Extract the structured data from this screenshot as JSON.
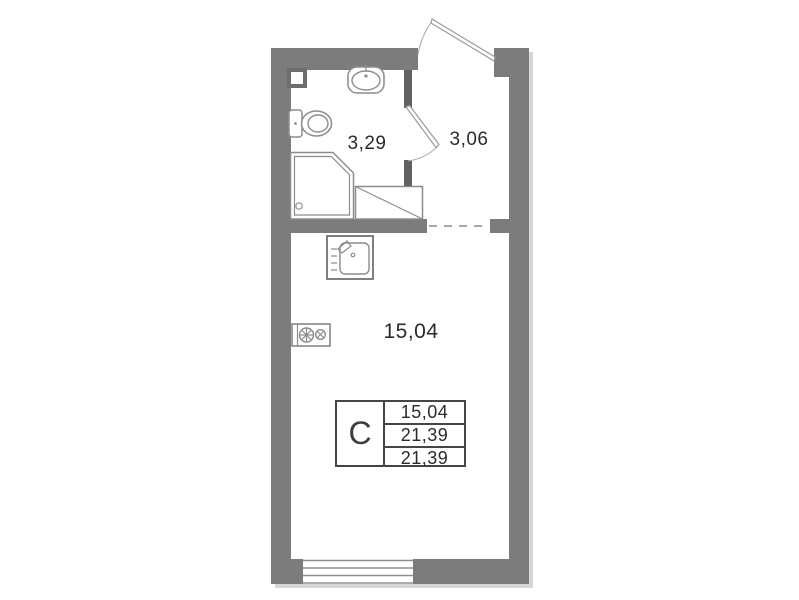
{
  "plan": {
    "kind": "studio apartment floor plan",
    "unit_type_letter": "С",
    "rooms": {
      "living_room": {
        "name": "living-room",
        "area": "15,04"
      },
      "bathroom": {
        "name": "bathroom",
        "area": "3,29"
      },
      "hallway": {
        "name": "hallway",
        "area": "3,06"
      }
    },
    "legend": {
      "type_letter": "С",
      "rows": [
        "15,04",
        "21,39",
        "21,39"
      ]
    },
    "icons": {
      "toilet-icon": "tank rectangle + oval bowl outline",
      "bath-sink-icon": "rounded rectangle with oval basin and tap tick",
      "shower-tray-icon": "square with chamfered corner, double outline, drain circle",
      "washing-machine-icon": "rectangle with diagonal line",
      "kitchen-sink-icon": "square with rounded basin, tap lever and drainboard ticks",
      "stove-icon": "wall rectangle with two burner circles",
      "vent-shaft-icon": "small bordered square in wall corner",
      "entrance-door-icon": "door leaf with swing arc at top opening",
      "interior-door-icon": "door leaf with swing arc between bathroom and hallway",
      "window-icon": "four parallel lines across bottom wall",
      "boundary-dashed-line": "dashed virtual boundary between hallway and room"
    },
    "colors": {
      "wall": "#7c7c7c",
      "wall_dark": "#616161",
      "fixture": "#8c8c8c",
      "door": "#9a9a9a",
      "dashed": "#a8a8a8",
      "table_border": "#454545",
      "text": "#2b2b2b",
      "shadow": "#d6d6d6",
      "window_line": "#8f8f8f",
      "background": "#ffffff"
    }
  }
}
